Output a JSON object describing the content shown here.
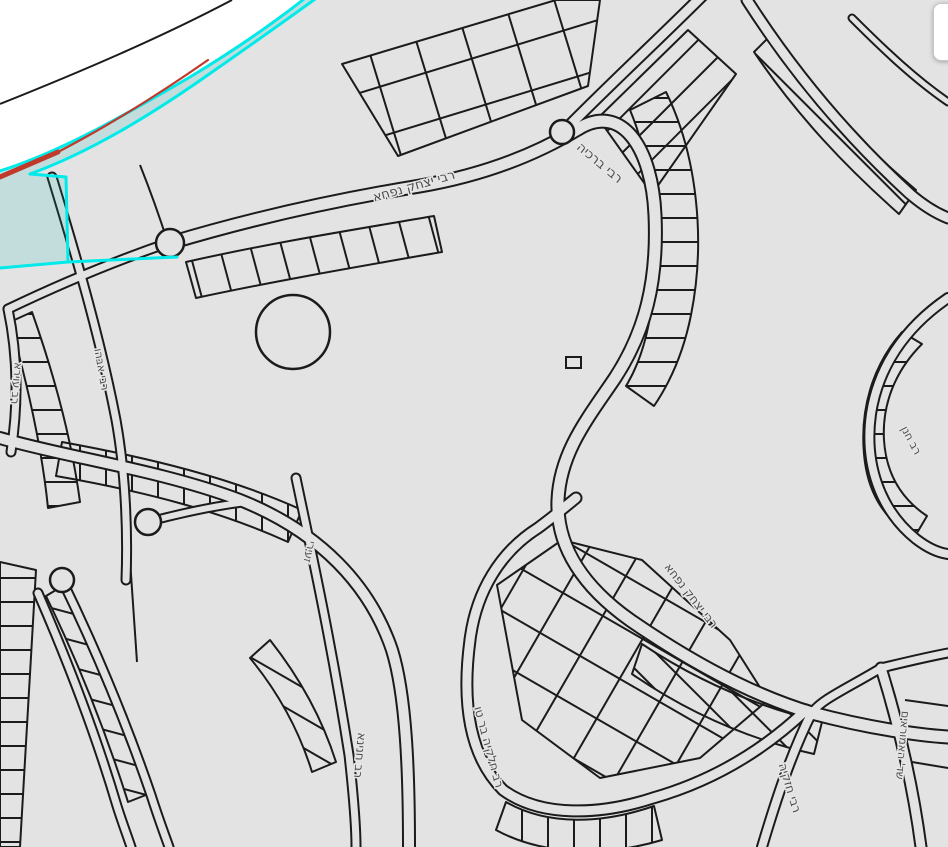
{
  "app": {
    "view": "map-canvas"
  },
  "colors": {
    "map_background": "#e3e3e3",
    "outside_area": "#ffffff",
    "parcel_line": "#1b1b1b",
    "label_text": "#4d4d4d",
    "label_halo": "#e6e6e6",
    "selection_stroke": "#00eaea",
    "selection_fill": "rgba(0,185,185,0.14)",
    "selection_red_line": "#bf3a2b",
    "corner_card_bg": "#ffffff"
  },
  "street_labels": [
    {
      "text": "רבי יצחק נפחא",
      "x": 415,
      "y": 190,
      "rot": -16,
      "size": 13
    },
    {
      "text": "רבי ברכיה",
      "x": 597,
      "y": 166,
      "rot": 40,
      "size": 13
    },
    {
      "text": "רב עוירא",
      "x": 13,
      "y": 383,
      "rot": 95,
      "size": 11
    },
    {
      "text": "רבי אבהו",
      "x": 98,
      "y": 370,
      "rot": 80,
      "size": 11
    },
    {
      "text": "זעירי",
      "x": 306,
      "y": 551,
      "rot": 103,
      "size": 11
    },
    {
      "text": "רב חנינא",
      "x": 356,
      "y": 755,
      "rot": 95,
      "size": 12
    },
    {
      "text": "רב חלקיה בר טו",
      "x": 485,
      "y": 748,
      "rot": 75,
      "size": 12
    },
    {
      "text": "רבי יצחק נפחא",
      "x": 688,
      "y": 598,
      "rot": 52,
      "size": 12
    },
    {
      "text": "רב חנן",
      "x": 908,
      "y": 442,
      "rot": 62,
      "size": 11
    },
    {
      "text": "שד' האמוראים",
      "x": 899,
      "y": 745,
      "rot": 95,
      "size": 11
    },
    {
      "text": "רבי חזקיה",
      "x": 786,
      "y": 789,
      "rot": 73,
      "size": 12
    }
  ]
}
